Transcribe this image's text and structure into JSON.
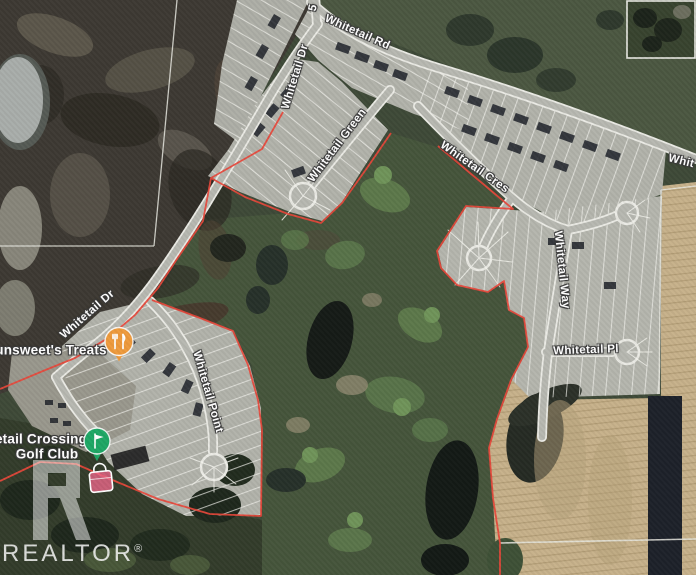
{
  "map": {
    "view": "satellite",
    "boundary_color": "#e8473a",
    "street_labels": {
      "whitetail_rd": "Whitetail Rd",
      "whitetail_dr_top": "Whitetail Dr",
      "whitetail_dr_lower": "Whitetail Dr",
      "whitetail_green": "Whitetail Green",
      "whitetail_cres": "Whitetail Cres",
      "whitetail_way": "Whitetail Way",
      "whitetail_pl": "Whitetail Pl",
      "whitetail_point": "Whitetail Point",
      "street_partial_top": "5",
      "street_partial_right": "Whit"
    },
    "pois": {
      "treats": {
        "label": "unsweet's Treats",
        "icon": "restaurant-icon",
        "pin_color": "#ee9a3c"
      },
      "golf_club": {
        "label_line1": "etail Crossing",
        "label_line2": "Golf Club",
        "icon": "golf-flag-icon",
        "pin_color": "#1ea765"
      },
      "shopping": {
        "icon": "shopping-bag-icon",
        "pin_color": "#f2688c"
      }
    },
    "watermark": {
      "brand": "REALTOR",
      "registered_mark": "®"
    }
  }
}
